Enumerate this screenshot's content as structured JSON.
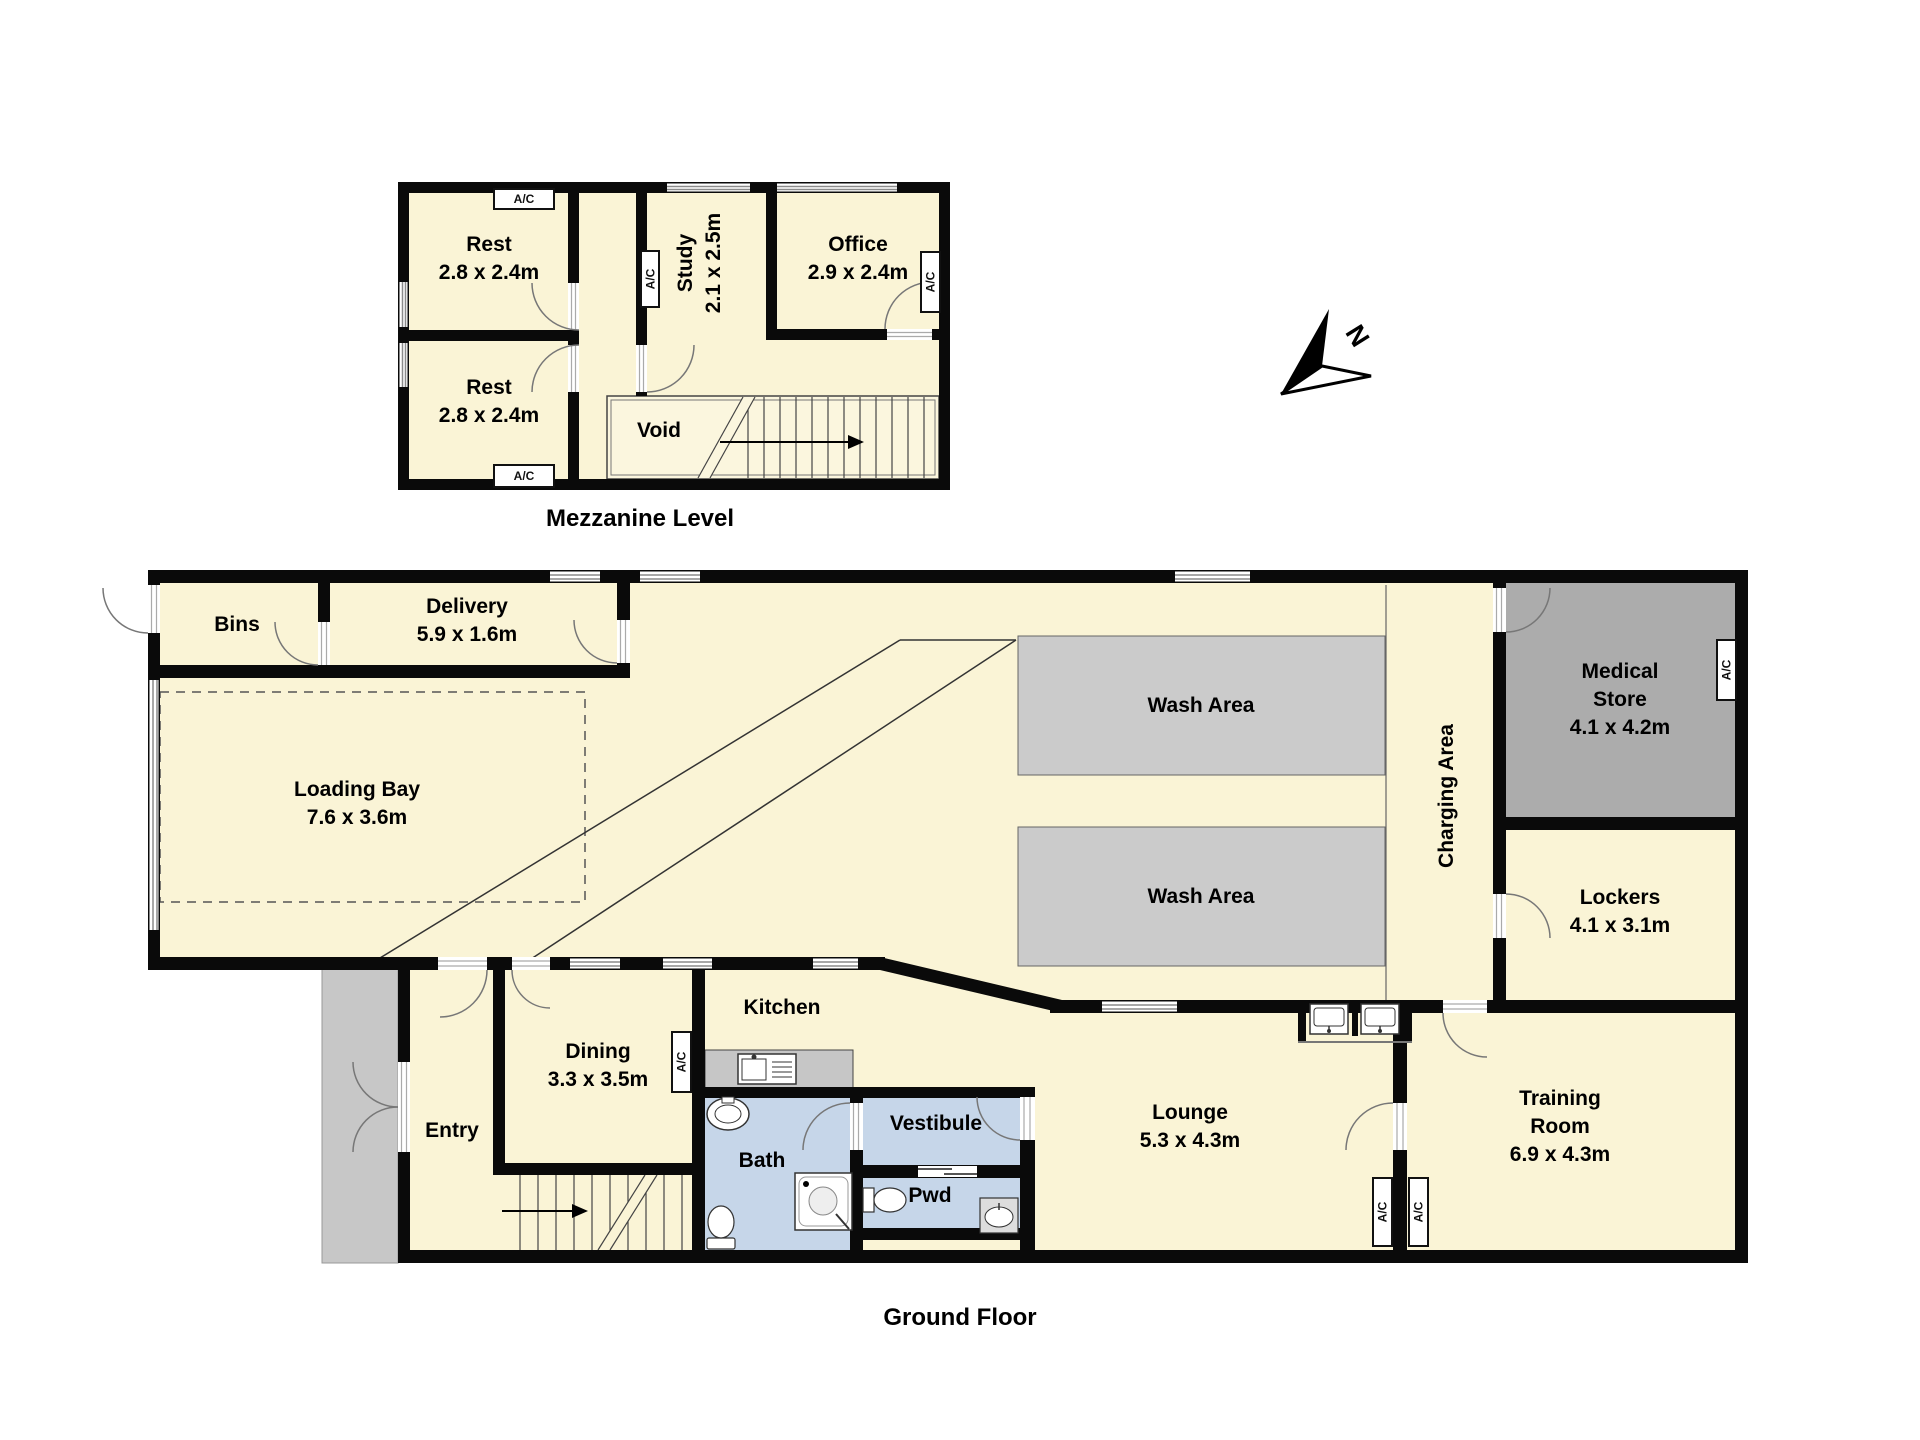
{
  "titles": {
    "mezzanine": "Mezzanine Level",
    "ground": "Ground Floor"
  },
  "compass": {
    "label": "N"
  },
  "labels": {
    "ac": "A/C"
  },
  "colors": {
    "room_cream": "#FAF4D6",
    "wash_gray": "#CBCBCB",
    "medical_gray": "#ACACAC",
    "wet_blue": "#C6D6E9",
    "porch_gray": "#C7C7C7",
    "counter_gray": "#C6C6C6"
  },
  "mezzanine": {
    "rest1": {
      "name": "Rest",
      "dims": "2.8 x 2.4m"
    },
    "rest2": {
      "name": "Rest",
      "dims": "2.8 x 2.4m"
    },
    "study": {
      "name": "Study",
      "dims": "2.1 x 2.5m"
    },
    "office": {
      "name": "Office",
      "dims": "2.9 x 2.4m"
    },
    "void": {
      "name": "Void"
    }
  },
  "ground": {
    "bins": {
      "name": "Bins"
    },
    "delivery": {
      "name": "Delivery",
      "dims": "5.9 x 1.6m"
    },
    "loading": {
      "name": "Loading Bay",
      "dims": "7.6 x 3.6m"
    },
    "wash1": {
      "name": "Wash Area"
    },
    "wash2": {
      "name": "Wash Area"
    },
    "charging": {
      "name": "Charging Area"
    },
    "medical": {
      "name1": "Medical",
      "name2": "Store",
      "dims": "4.1 x 4.2m"
    },
    "lockers": {
      "name": "Lockers",
      "dims": "4.1 x 3.1m"
    },
    "kitchen": {
      "name": "Kitchen"
    },
    "dining": {
      "name": "Dining",
      "dims": "3.3 x 3.5m"
    },
    "entry": {
      "name": "Entry"
    },
    "bath": {
      "name": "Bath"
    },
    "vestibule": {
      "name": "Vestibule"
    },
    "pwd": {
      "name": "Pwd"
    },
    "lounge": {
      "name": "Lounge",
      "dims": "5.3 x 4.3m"
    },
    "training": {
      "name1": "Training",
      "name2": "Room",
      "dims": "6.9 x 4.3m"
    }
  }
}
